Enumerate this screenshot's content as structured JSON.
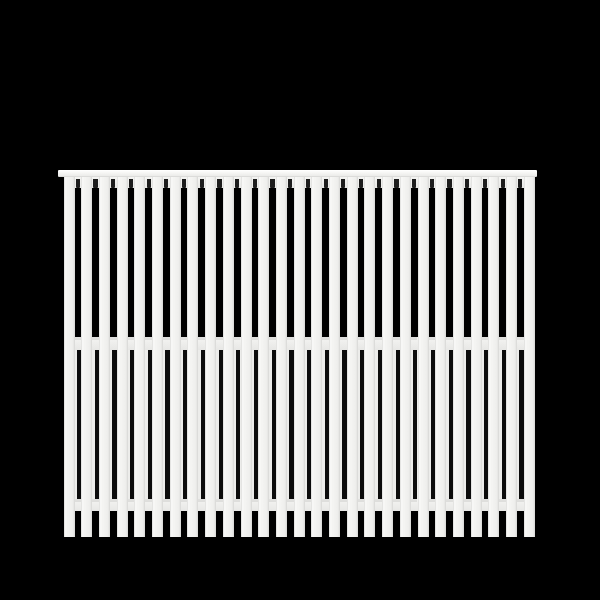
{
  "scene": {
    "description": "Product photo of a white vertical-slat wooden fence panel on a black background",
    "background_color": "#000000"
  },
  "fence": {
    "panel_color": "#f3f3f1",
    "gap_color": "#0a0a0a",
    "cap_rail": {
      "x": 58,
      "y": 170,
      "width": 478.5,
      "height": 7
    },
    "slats": {
      "count": 27,
      "left": 63.5,
      "top": 176.5,
      "bottom": 536.7,
      "width": 11,
      "period": 17.7
    },
    "gaps": {
      "count": 26,
      "width": 6.7
    },
    "top_rail": {
      "y": 176.5,
      "height": 11.5,
      "notch_width": 4.3,
      "notch_top": 178.5,
      "notch_height": 9.5,
      "notch_color": "#1d1d1d"
    },
    "middle_rail": {
      "y": 337,
      "height": 12.5
    },
    "bottom_rail": {
      "y": 499.3,
      "height": 11.4
    },
    "back_slats": {
      "top": 349.5,
      "bottom": 499.3,
      "dark_line_width": 4.3,
      "dark_line_offset": 2.4,
      "dark_line_color": "#0c0c0c"
    }
  }
}
